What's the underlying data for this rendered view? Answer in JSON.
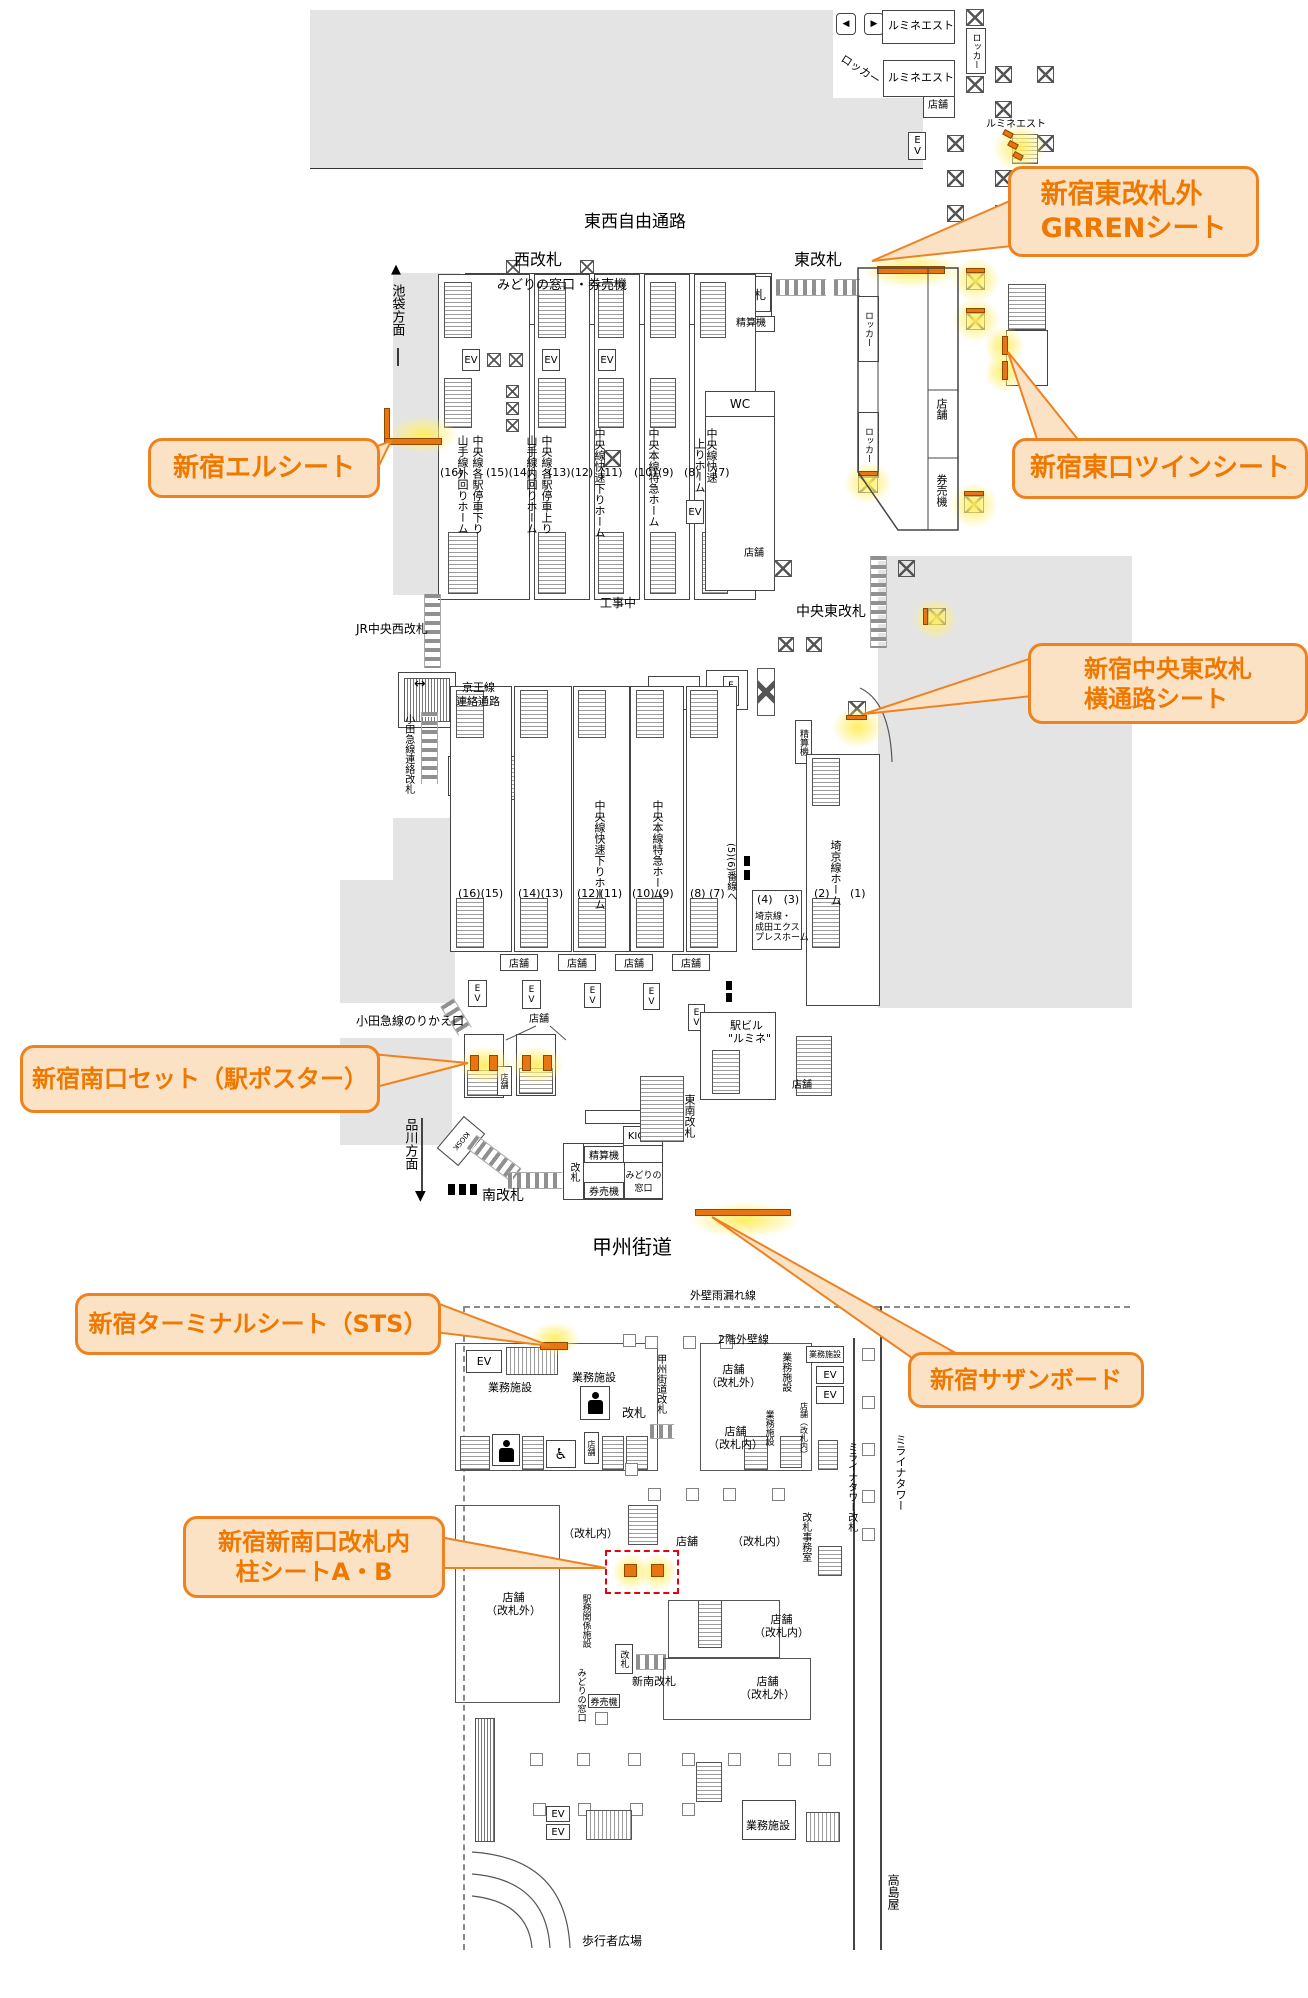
{
  "callouts": {
    "green_sheet": {
      "line1": "新宿東改札外",
      "line2": "GRRENシート"
    },
    "twin_sheet": {
      "line1": "新宿東口ツインシート"
    },
    "el_sheet": {
      "line1": "新宿エルシート"
    },
    "yokotsuro_sheet": {
      "line1": "新宿中央東改札",
      "line2": "横通路シート"
    },
    "minamiguchi_set": {
      "line1": "新宿南口セット（駅ポスター）"
    },
    "terminal_sheet": {
      "line1": "新宿ターミナルシート（STS）"
    },
    "southern_board": {
      "line1": "新宿サザンボード"
    },
    "hashira_sheet": {
      "line1": "新宿新南口改札内",
      "line2": "柱シートA・B"
    }
  },
  "labels": {
    "tozai_corridor": "東西自由通路",
    "nishi_kaisatsu": "西改札",
    "higashi_kaisatsu": "東改札",
    "chuo_higashi_kaisatsu": "中央東改札",
    "jr_chuo_nishi_kaisatsu": "JR中央西改札",
    "minami_kaisatsu": "南改札",
    "shinnan_kaisatsu": "新南改札",
    "tonan_kaisatsu": "東南改札",
    "koshu_kaido": "甲州街道",
    "koshu_kaido_kaisatsu": "甲州街道改札",
    "midori_kenbaiki": "みどりの窓口・券売機",
    "midori_madoguchi": "みどりの\n窓口",
    "midori_madoguchi_v": "みどりの窓口",
    "kaisatsu": "改札",
    "seisanki": "精算機",
    "kenbaiki": "券売機",
    "kiosk": "KIOSK",
    "ev": "EV",
    "wc": "WC",
    "tenpo": "店舗",
    "tenpo_kaisatsugai": "店舗\n（改札外）",
    "tenpo_kaisatsunai": "店舗\n（改札内）",
    "tenpo_kaisatsunai_v": "店舗（改札内）",
    "kaisatsunai": "（改札内）",
    "locker": "ロッカー",
    "lumine_est": "ルミネエスト",
    "ekibiru": "駅ビル",
    "lumine_quoted": "\"ルミネ\"",
    "gyomu_shisetsu": "業務施設",
    "kojichu": "工事中",
    "ikebukuro_homen": "池袋方面",
    "shinagawa_homen": "品川方面",
    "keio_1": "京王線",
    "keio_2": "連絡通路",
    "odakyu_renraku": "小田急線連絡改札",
    "odakyu_norikae": "小田急線のりかえ口",
    "yamanote_soto": "山手線外回りホーム",
    "yamanote_uchi": "山手線内回りホーム",
    "chuo_kakueki_kudari": "中央線各駅停車下り",
    "chuo_kakueki_nobori": "中央線各駅停車上り",
    "chuo_kaisoku_kudari": "中央線快速下りホーム",
    "chuo_honsen_tokkyu": "中央本線特急ホーム",
    "chuo_kaisoku": "中央線快速",
    "nobori_home": "上りホーム",
    "saikyo_home": "埼京線ホーム",
    "n56_bansen": "(5)(6)番線へ",
    "saikyo_narita": "埼京線・\n成田エクス\nプレスホーム",
    "n16": "(16)",
    "n15_14": "(15)(14)",
    "n13_12": "(13)(12)",
    "n11": "(11)",
    "n10": "(10)",
    "n9": "(9)",
    "n8": "(8)",
    "n7": "(7)",
    "n16_15": "(16)(15)",
    "n14_13": "(14)(13)",
    "n12_11": "(12)(11)",
    "n10_9": "(10) (9)",
    "n8_7": "(8) (7)",
    "n2": "(2)",
    "n1": "(1)",
    "n4_3": "(4)　(3)",
    "gaiheki_amamore": "外壁雨漏れ線",
    "nikai_gaiheki": "2階外壁線",
    "mirai_kaisatsu": "ミライナタワー改札",
    "mirai_tower": "ミライナタワー",
    "takashimaya": "高島屋",
    "kaisatsu_jimu": "改札事務室",
    "ekimu_shisetsu": "駅務関係施設",
    "hokosha_hiroba": "歩行者広場"
  },
  "icons": {
    "up_arrow": "▲",
    "down_arrow": "▼",
    "lr_arrow": "↔",
    "left_arrow": "◀",
    "right_arrow": "▶",
    "wheelchair": "♿"
  },
  "colors": {
    "highlight_orange": "#e8750f",
    "glow_yellow": "#fff05a",
    "callout_bg": "#fbe2c5",
    "callout_border": "#ee8220",
    "callout_text": "#ee7800",
    "alert_red": "#e60012"
  }
}
